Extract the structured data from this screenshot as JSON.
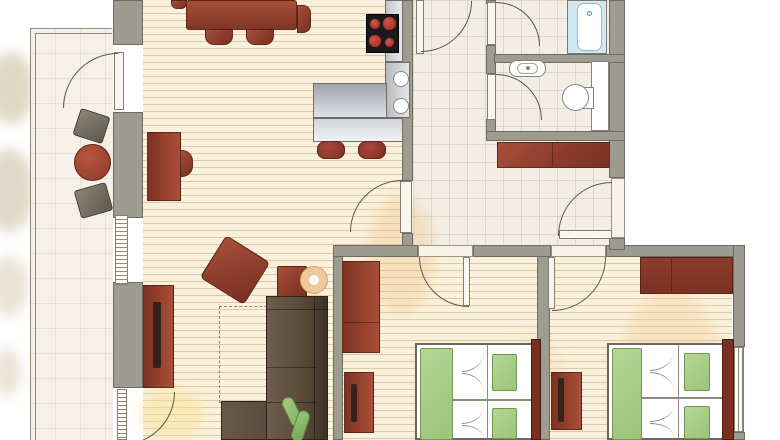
{
  "meta": {
    "title": "Apartment floor plan (top-down)",
    "canvas_width": 780,
    "canvas_height": 440,
    "visible_text": "none"
  },
  "palette": {
    "wall_gray": "#9e9b90",
    "wood_floor": "#faf1dc",
    "tile_floor": "#f3eee4",
    "furniture_red": "#8d3c2c",
    "sofa_brown": "#55443a",
    "bed_green": "#a8cf8a",
    "counter_steel": "#c9cdd2",
    "bathtub_blue": "#cfe7f1",
    "stove_black": "#1a1a1d",
    "burner_red": "#b8322a"
  },
  "rooms": [
    {
      "id": "balcony",
      "name": "Balcony",
      "floor": "tile",
      "furniture": [
        "round-bistro-table",
        "balcony-chair-upper",
        "balcony-chair-lower"
      ]
    },
    {
      "id": "living-dining",
      "name": "Living / dining room",
      "floor": "wood",
      "furniture": [
        "dining-table",
        "dining-chairs x4",
        "desk",
        "desk-chair",
        "tv-sideboard",
        "armchair",
        "side-table",
        "decor-bowl",
        "rug-dashed",
        "corner-sofa",
        "potted-plant"
      ]
    },
    {
      "id": "kitchen",
      "name": "Open kitchen",
      "floor": "wood",
      "furniture": [
        "counter-L",
        "breakfast-bar",
        "cooktop-4-burners",
        "double-sink",
        "bar-stool x2"
      ]
    },
    {
      "id": "hallway",
      "name": "Entrance hall",
      "floor": "tile",
      "furniture": [
        "hall-sideboard"
      ],
      "doors": [
        "entry-door",
        "door-to-living",
        "door-top"
      ]
    },
    {
      "id": "bathroom",
      "name": "Bathroom",
      "floor": "tile",
      "fixtures": [
        "bathtub"
      ]
    },
    {
      "id": "wc",
      "name": "WC",
      "floor": "tile",
      "fixtures": [
        "wash-basin",
        "toilet",
        "cistern-counter"
      ]
    },
    {
      "id": "bedroom-middle",
      "name": "Bedroom 1",
      "floor": "wood",
      "furniture": [
        "wardrobe-tall",
        "dresser",
        "double-bed-green",
        "headboard"
      ]
    },
    {
      "id": "bedroom-right",
      "name": "Bedroom 2",
      "floor": "wood",
      "furniture": [
        "wardrobe-wide",
        "nightstand",
        "double-bed-green",
        "headboard"
      ]
    }
  ],
  "openings": {
    "balcony_doors": 2,
    "interior_doors": 6,
    "entry_door": 1,
    "windows": [
      "living-west-window",
      "bedroom2-east-window"
    ]
  }
}
